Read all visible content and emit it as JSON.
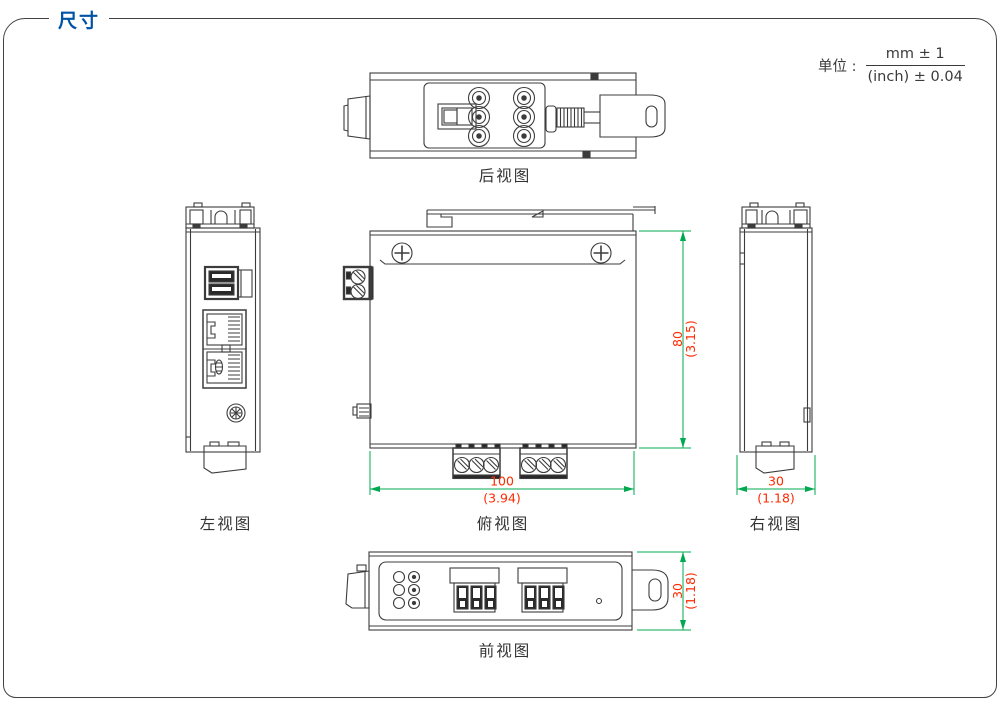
{
  "header": {
    "title": "尺寸"
  },
  "units": {
    "label": "单位 :",
    "numerator": "mm ± 1",
    "denominator": "(inch) ± 0.04"
  },
  "views": {
    "rear": {
      "label": "后视图"
    },
    "left": {
      "label": "左视图"
    },
    "top": {
      "label": "俯视图"
    },
    "right": {
      "label": "右视图"
    },
    "front": {
      "label": "前视图"
    }
  },
  "dimensions": {
    "top_view_height": {
      "mm": "80",
      "inch": "(3.15)"
    },
    "top_view_width": {
      "mm": "100",
      "inch": "(3.94)"
    },
    "right_view_width": {
      "mm": "30",
      "inch": "(1.18)"
    },
    "front_view_height": {
      "mm": "30",
      "inch": "(1.18)"
    }
  },
  "colors": {
    "title_blue": "#0054A8",
    "dimension_line_green": "#00A94F",
    "dimension_text_red": "#FF2A00",
    "drawing_line": "#3C3C3C",
    "frame_border": "#424242"
  }
}
